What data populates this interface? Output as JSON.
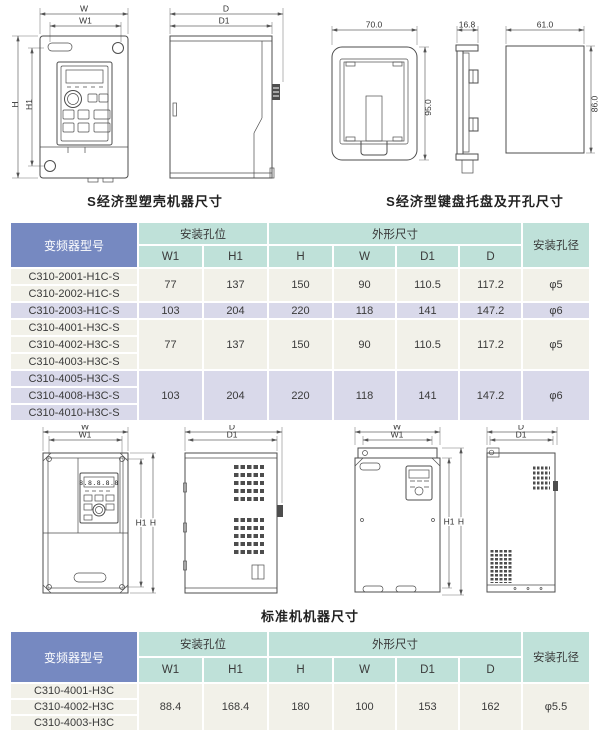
{
  "colors": {
    "header_blue": "#7689c1",
    "header_teal": "#bfe1d9",
    "row_cream": "#f2f1e9",
    "row_lavender": "#d9d9ea",
    "drawing_line": "#4d4d4d",
    "text": "#3a3a3a"
  },
  "captions": {
    "s_machine": "S经济型塑壳机器尺寸",
    "s_keypad": "S经济型键盘托盘及开孔尺寸",
    "standard_machine": "标准机机器尺寸"
  },
  "dims": {
    "w": "W",
    "w1": "W1",
    "h": "H",
    "h1": "H1",
    "d": "D",
    "d1": "D1",
    "tray_width": "70.0",
    "tray_height": "95.0",
    "tray_depth": "16.8",
    "cutout_width": "61.0",
    "cutout_height": "86.0"
  },
  "keypad_display": "8.8.8.8.8",
  "table_header": {
    "model": "变频器型号",
    "mounting_holes": "安装孔位",
    "outline_dims": "外形尺寸",
    "hole_diameter": "安装孔径",
    "w1": "W1",
    "h1": "H1",
    "h": "H",
    "w": "W",
    "d1": "D1",
    "d": "D"
  },
  "table1": {
    "groups": [
      {
        "models": [
          "C310-2001-H1C-S",
          "C310-2002-H1C-S"
        ],
        "w1": "77",
        "h1": "137",
        "h": "150",
        "w": "90",
        "d1": "110.5",
        "d": "117.2",
        "hole": "φ5"
      },
      {
        "models": [
          "C310-2003-H1C-S"
        ],
        "w1": "103",
        "h1": "204",
        "h": "220",
        "w": "118",
        "d1": "141",
        "d": "147.2",
        "hole": "φ6"
      },
      {
        "models": [
          "C310-4001-H3C-S",
          "C310-4002-H3C-S",
          "C310-4003-H3C-S"
        ],
        "w1": "77",
        "h1": "137",
        "h": "150",
        "w": "90",
        "d1": "110.5",
        "d": "117.2",
        "hole": "φ5"
      },
      {
        "models": [
          "C310-4005-H3C-S",
          "C310-4008-H3C-S",
          "C310-4010-H3C-S"
        ],
        "w1": "103",
        "h1": "204",
        "h": "220",
        "w": "118",
        "d1": "141",
        "d": "147.2",
        "hole": "φ6"
      }
    ]
  },
  "table2": {
    "groups": [
      {
        "models": [
          "C310-4001-H3C",
          "C310-4002-H3C",
          "C310-4003-H3C"
        ],
        "w1": "88.4",
        "h1": "168.4",
        "h": "180",
        "w": "100",
        "d1": "153",
        "d": "162",
        "hole": "φ5.5"
      }
    ]
  }
}
